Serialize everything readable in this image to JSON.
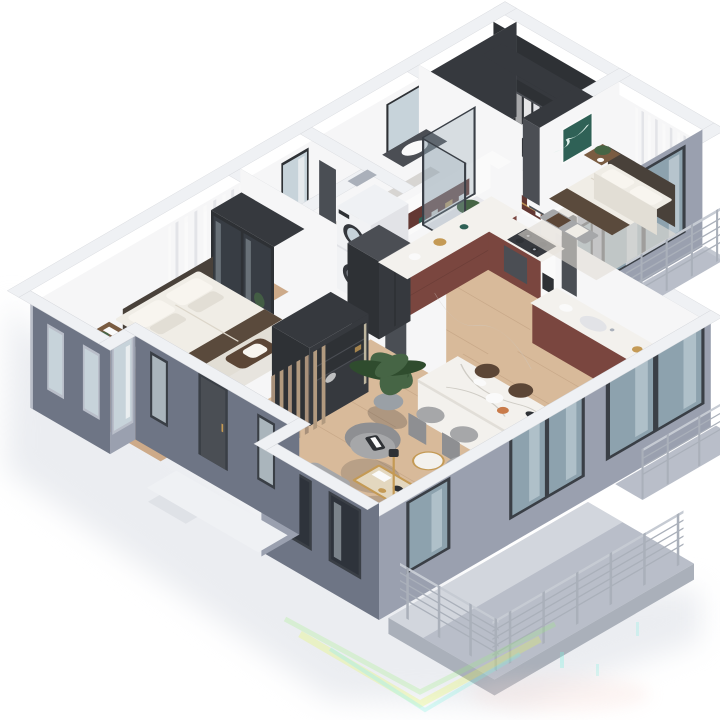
{
  "image": {
    "kind": "isometric-3d-floor-plan-render",
    "width_px": 720,
    "height_px": 720,
    "background": "#ffffff"
  },
  "palette": {
    "bg": "#ffffff",
    "groundShadow": "#e8eaef",
    "extDark": "#6e7585",
    "extMid": "#9aa0af",
    "extLight": "#b9bec9",
    "band": "#eff1f4",
    "bandEdge": "#d8dade",
    "innerWhite": "#f6f6f7",
    "innerShade": "#e2e3e7",
    "wood": "#cdaa89",
    "woodLight": "#d8ba9a",
    "woodLine": "#ad8a6b",
    "darkFloor": "#47494e",
    "bathFloor": "#d7d5d2",
    "charcoal": "#36393e",
    "charcoalHi": "#4b4e54",
    "doorDark": "#4a4e54",
    "maroon": "#7a463f",
    "maroonDark": "#633833",
    "marble": "#f3f1ed",
    "marbleShade": "#e1ded8",
    "vein": "#cfccc5",
    "white": "#fafafa",
    "bedWhite": "#f0ede6",
    "bedShade": "#e2ded5",
    "pillow": "#f8f5ef",
    "headboard": "#49413a",
    "throw": "#5a4a3c",
    "benchBrown": "#5c4636",
    "woodFurn": "#7a5c42",
    "sofa": "#a6a7a9",
    "sofaDark": "#8e8f92",
    "cushion": "#2e3135",
    "plantG": "#466545",
    "plantD": "#2f4c2e",
    "potGray": "#9aa0a6",
    "teal": "#2f6156",
    "glass": "#8da2ae",
    "glassLight": "#c7d3da",
    "frame": "#3a3f46",
    "rail": "#c6cbd3",
    "steel": "#aab0ba",
    "gold": "#c49a55",
    "washerWhite": "#f1f2f4",
    "drum": "#34373c",
    "artifactYellow": "#e4fa52",
    "artifactGreen": "#9af07a",
    "artifactCyan": "#79f2df",
    "artifactPink": "#f6d8d2"
  },
  "scene": {
    "projection": "isometric",
    "rooms": [
      {
        "id": "walk-in-closet",
        "floor": "dark-gray",
        "furniture": [
          "wardrobe-with-clothes",
          "side-wardrobe",
          "white-box"
        ]
      },
      {
        "id": "bedroom-2",
        "floor": "wood",
        "furniture": [
          "double-bed",
          "headboard",
          "foot-bench-with-towels",
          "nightstand-with-plant",
          "green-artwork",
          "curtained-window",
          "sliding-balcony-door",
          "rug"
        ]
      },
      {
        "id": "bathroom",
        "floor": "tile",
        "furniture": [
          "vanity-with-mirror",
          "toilet",
          "glass-shower-enclosure",
          "plant"
        ]
      },
      {
        "id": "laundry-nook",
        "furniture": [
          "stacked-washer-dryer"
        ]
      },
      {
        "id": "hallway",
        "furniture": [
          "wall-mirror",
          "dark-door"
        ]
      },
      {
        "id": "kitchen",
        "furniture": [
          "l-shaped-counter",
          "upper-cabinets-open-shelves",
          "gas-cooktop",
          "hood",
          "refrigerator",
          "tall-column-coffee-station",
          "window-bar-counter-with-sink"
        ]
      },
      {
        "id": "dining",
        "furniture": [
          "long-marble-island",
          "gray-chairs-2",
          "dark-stools-2",
          "decor"
        ]
      },
      {
        "id": "living-room",
        "furniture": [
          "armchair-2",
          "loveseat",
          "glass-gold-coffee-table",
          "round-marble-side-table",
          "white-round-drinks-table",
          "gold-floor-lamp",
          "large-plant"
        ]
      },
      {
        "id": "master-bedroom",
        "floor": "wood",
        "furniture": [
          "double-bed",
          "dark-glass-wardrobe",
          "nightstand",
          "brown-lounge-chair",
          "rug",
          "curtained-window"
        ]
      },
      {
        "id": "entry",
        "furniture": [
          "charcoal-storage-cabinet",
          "wood-slat-screen",
          "front-door",
          "porch-landing"
        ]
      },
      {
        "id": "balcony-small-bedroom",
        "furniture": [
          "metal-railing"
        ]
      },
      {
        "id": "balcony-juliet-kitchen",
        "furniture": [
          "metal-railing"
        ]
      },
      {
        "id": "terrace-large",
        "furniture": [
          "metal-railing-l-shape"
        ]
      }
    ],
    "exterior": {
      "walls": "blue-gray",
      "windows": "dark-framed",
      "artifacts": "rainbow-compression-streaks-bottom"
    }
  }
}
